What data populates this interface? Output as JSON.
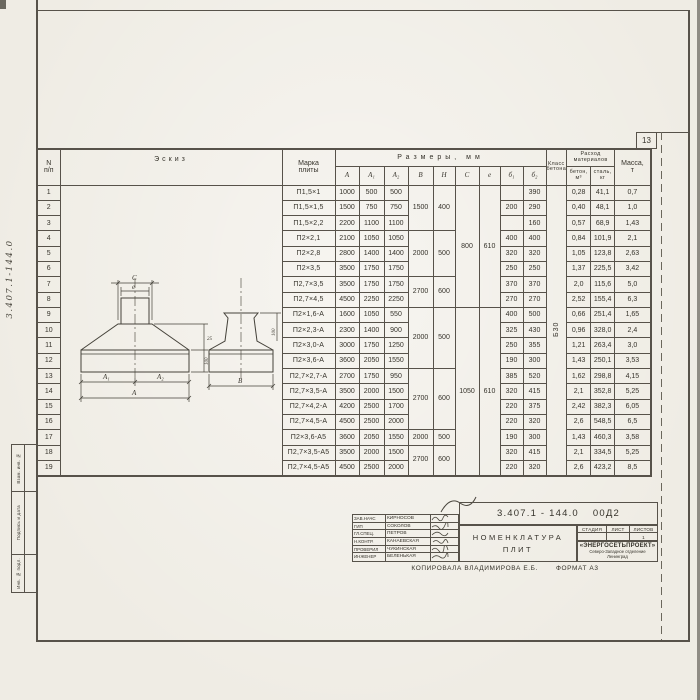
{
  "page": {
    "sheet_number": "13",
    "margin_code": "3.407.1-144.0",
    "margin_stamps": [
      "Взам. инв. №",
      "Подпись и дата",
      "Инв. № подл."
    ],
    "copy_line": "Копировала  Владимирова Е.Б.",
    "format_line": "Формат А3"
  },
  "table": {
    "col_headers": {
      "num_top": "N",
      "num_bottom": "п/п",
      "sketch": "Эскиз",
      "mark_l1": "Марка",
      "mark_l2": "плиты",
      "sizes_group": "Размеры, мм",
      "size_cols": [
        "А",
        "А₁",
        "А₂",
        "В",
        "Н",
        "С",
        "е",
        "б₁",
        "б₂"
      ],
      "class_l1": "Класс",
      "class_l2": "бетона",
      "materials_l1": "Расход",
      "materials_l2": "материалов",
      "concrete_col_l1": "бетон,",
      "concrete_col_l2": "м³",
      "steel_col_l1": "сталь,",
      "steel_col_l2": "кг",
      "mass_l1": "Масса,",
      "mass_l2": "т"
    },
    "concrete_class": "Б30",
    "rows": [
      {
        "n": "1",
        "mark": "П1,5×1",
        "A": "1000",
        "A1": "500",
        "A2": "500",
        "b1": "",
        "b2": "390",
        "concrete": "0,28",
        "steel": "41,1",
        "mass": "0,7"
      },
      {
        "n": "2",
        "mark": "П1,5×1,5",
        "A": "1500",
        "A1": "750",
        "A2": "750",
        "b1": "200",
        "b2": "290",
        "concrete": "0,40",
        "steel": "48,1",
        "mass": "1,0"
      },
      {
        "n": "3",
        "mark": "П1,5×2,2",
        "A": "2200",
        "A1": "1100",
        "A2": "1100",
        "b1": "",
        "b2": "160",
        "concrete": "0,57",
        "steel": "68,9",
        "mass": "1,43"
      },
      {
        "n": "4",
        "mark": "П2×2,1",
        "A": "2100",
        "A1": "1050",
        "A2": "1050",
        "b1": "400",
        "b2": "400",
        "concrete": "0,84",
        "steel": "101,9",
        "mass": "2,1"
      },
      {
        "n": "5",
        "mark": "П2×2,8",
        "A": "2800",
        "A1": "1400",
        "A2": "1400",
        "b1": "320",
        "b2": "320",
        "concrete": "1,05",
        "steel": "123,8",
        "mass": "2,63"
      },
      {
        "n": "6",
        "mark": "П2×3,5",
        "A": "3500",
        "A1": "1750",
        "A2": "1750",
        "b1": "250",
        "b2": "250",
        "concrete": "1,37",
        "steel": "225,5",
        "mass": "3,42"
      },
      {
        "n": "7",
        "mark": "П2,7×3,5",
        "A": "3500",
        "A1": "1750",
        "A2": "1750",
        "b1": "370",
        "b2": "370",
        "concrete": "2,0",
        "steel": "115,6",
        "mass": "5,0"
      },
      {
        "n": "8",
        "mark": "П2,7×4,5",
        "A": "4500",
        "A1": "2250",
        "A2": "2250",
        "b1": "270",
        "b2": "270",
        "concrete": "2,52",
        "steel": "155,4",
        "mass": "6,3"
      },
      {
        "n": "9",
        "mark": "П2×1,6-А",
        "A": "1600",
        "A1": "1050",
        "A2": "550",
        "b1": "400",
        "b2": "500",
        "concrete": "0,66",
        "steel": "251,4",
        "mass": "1,65"
      },
      {
        "n": "10",
        "mark": "П2×2,3-А",
        "A": "2300",
        "A1": "1400",
        "A2": "900",
        "b1": "325",
        "b2": "430",
        "concrete": "0,96",
        "steel": "328,0",
        "mass": "2,4"
      },
      {
        "n": "11",
        "mark": "П2×3,0-А",
        "A": "3000",
        "A1": "1750",
        "A2": "1250",
        "b1": "250",
        "b2": "355",
        "concrete": "1,21",
        "steel": "263,4",
        "mass": "3,0"
      },
      {
        "n": "12",
        "mark": "П2×3,6-А",
        "A": "3600",
        "A1": "2050",
        "A2": "1550",
        "b1": "190",
        "b2": "300",
        "concrete": "1,43",
        "steel": "250,1",
        "mass": "3,53"
      },
      {
        "n": "13",
        "mark": "П2,7×2,7-А",
        "A": "2700",
        "A1": "1750",
        "A2": "950",
        "b1": "385",
        "b2": "520",
        "concrete": "1,62",
        "steel": "298,8",
        "mass": "4,15"
      },
      {
        "n": "14",
        "mark": "П2,7×3,5-А",
        "A": "3500",
        "A1": "2000",
        "A2": "1500",
        "b1": "320",
        "b2": "415",
        "concrete": "2,1",
        "steel": "352,8",
        "mass": "5,25"
      },
      {
        "n": "15",
        "mark": "П2,7×4,2-А",
        "A": "4200",
        "A1": "2500",
        "A2": "1700",
        "b1": "220",
        "b2": "375",
        "concrete": "2,42",
        "steel": "382,3",
        "mass": "6,05"
      },
      {
        "n": "16",
        "mark": "П2,7×4,5-А",
        "A": "4500",
        "A1": "2500",
        "A2": "2000",
        "b1": "220",
        "b2": "320",
        "concrete": "2,6",
        "steel": "548,5",
        "mass": "6,5"
      },
      {
        "n": "17",
        "mark": "П2×3,6-А5",
        "A": "3600",
        "A1": "2050",
        "A2": "1550",
        "b1": "190",
        "b2": "300",
        "concrete": "1,43",
        "steel": "460,3",
        "mass": "3,58"
      },
      {
        "n": "18",
        "mark": "П2,7×3,5-А5",
        "A": "3500",
        "A1": "2000",
        "A2": "1500",
        "b1": "320",
        "b2": "415",
        "concrete": "2,1",
        "steel": "334,5",
        "mass": "5,25"
      },
      {
        "n": "19",
        "mark": "П2,7×4,5-А5",
        "A": "4500",
        "A1": "2500",
        "A2": "2000",
        "b1": "220",
        "b2": "320",
        "concrete": "2,6",
        "steel": "423,2",
        "mass": "8,5"
      }
    ],
    "merged": {
      "BH": [
        {
          "from": 1,
          "to": 3,
          "B": "1500",
          "H": "400"
        },
        {
          "from": 4,
          "to": 6,
          "B": "2000",
          "H": "500"
        },
        {
          "from": 7,
          "to": 8,
          "B": "2700",
          "H": "600"
        },
        {
          "from": 9,
          "to": 12,
          "B": "2000",
          "H": "500"
        },
        {
          "from": 13,
          "to": 16,
          "B": "2700",
          "H": "600"
        },
        {
          "from": 17,
          "to": 17,
          "B": "2000",
          "H": "500"
        },
        {
          "from": 18,
          "to": 19,
          "B": "2700",
          "H": "600"
        }
      ],
      "C": [
        {
          "from": 1,
          "to": 8,
          "value": "800"
        },
        {
          "from": 9,
          "to": 19,
          "value": "1050"
        }
      ],
      "e": [
        {
          "from": 1,
          "to": 8,
          "value": "610"
        },
        {
          "from": 9,
          "to": 19,
          "value": "610"
        }
      ]
    }
  },
  "sketch_labels": {
    "c": "С",
    "e": "е",
    "a1": "А₁",
    "a2": "А₂",
    "a": "А",
    "b": "В",
    "dim25": "25",
    "dim100_left": "100",
    "dim100_right": "100"
  },
  "titleblock": {
    "doc_number": "3.407.1 - 144.0",
    "doc_suffix": "00Д2",
    "title_l1": "Номенклатура",
    "title_l2": "плит",
    "staff": [
      {
        "role": "Зав.НАЧС",
        "name": "Кирносов"
      },
      {
        "role": "ГИП",
        "name": "Соколов"
      },
      {
        "role": "Гл.спец.",
        "name": "Петров"
      },
      {
        "role": "Н.контр.",
        "name": "Канаевская"
      },
      {
        "role": "Проверил",
        "name": "Чукинская"
      },
      {
        "role": "Инженер",
        "name": "Беленькая"
      }
    ],
    "stage_headers": [
      "Стадия",
      "Лист",
      "Листов"
    ],
    "sheets_value": "1",
    "org_name": "«ЭНЕРГОСЕТЬПРОЕКТ»",
    "org_branch": "Северо-Западное отделение",
    "org_city": "Ленинград"
  }
}
